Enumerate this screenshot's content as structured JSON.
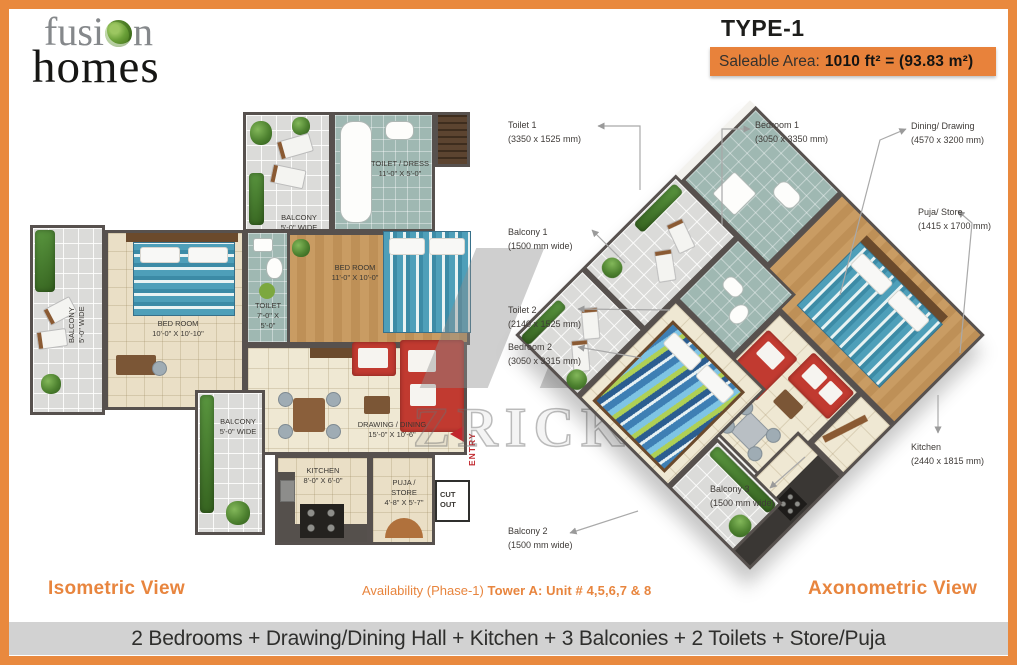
{
  "brand": {
    "line1_pre": "fusi",
    "line1_o": "o",
    "line1_post": "n",
    "line2": "homes",
    "full_name": "fusion homes"
  },
  "header": {
    "type_title": "TYPE-1",
    "saleable_label": "Saleable Area:",
    "saleable_value": "1010 ft² = (93.83 m²)"
  },
  "left_plan": {
    "rooms": {
      "toilet_dress": {
        "name": "TOILET / DRESS",
        "dims": "11'-0\" X 5'-0\""
      },
      "balcony_top": {
        "name": "BALCONY",
        "dims": "5'-0\" WIDE"
      },
      "bedroom_1": {
        "name": "BED ROOM",
        "dims": "11'-0\" X 10'-0\""
      },
      "balcony_left": {
        "name": "BALCONY",
        "dims": "5'-0\" WIDE"
      },
      "bedroom_2": {
        "name": "BED ROOM",
        "dims": "10'-0\" X 10'-10\""
      },
      "toilet": {
        "name": "TOILET",
        "dims": "7'-0\" X 5'-0\""
      },
      "drawing_dining": {
        "name": "DRAWING / DINING",
        "dims": "15'-0\" X 10'-6\""
      },
      "balcony_bottom": {
        "name": "BALCONY",
        "dims": "5'-0\" WIDE"
      },
      "kitchen": {
        "name": "KITCHEN",
        "dims": "8'-0\" X 6'-0\""
      },
      "puja_store": {
        "name": "PUJA / STORE",
        "dims": "4'-8\" X 5'-7\""
      },
      "cut_out": {
        "name": "CUT OUT"
      },
      "entry": {
        "name": "ENTRY"
      }
    }
  },
  "right_plan": {
    "callouts": [
      {
        "label": "Toilet 1",
        "dims": "(3350 x 1525 mm)"
      },
      {
        "label": "Bedroom 1",
        "dims": "(3050 x 3350 mm)"
      },
      {
        "label": "Dining/ Drawing",
        "dims": "(4570 x 3200 mm)"
      },
      {
        "label": "Balcony 1",
        "dims": "(1500 mm wide)"
      },
      {
        "label": "Puja/ Store",
        "dims": "(1415 x 1700 mm)"
      },
      {
        "label": "Toilet 2",
        "dims": "(2140 x 1525 mm)"
      },
      {
        "label": "Bedroom 2",
        "dims": "(3050 x 3315 mm)"
      },
      {
        "label": "Kitchen",
        "dims": "(2440 x 1815 mm)"
      },
      {
        "label": "Balcony 3",
        "dims": "(1500 mm wide)"
      },
      {
        "label": "Balcony 2",
        "dims": "(1500 mm wide)"
      }
    ]
  },
  "watermark": {
    "text": "ZRICKS",
    "suffix": "com"
  },
  "footer": {
    "left_view_label": "Isometric View",
    "availability_prefix": "Availability (Phase-1)",
    "availability_bold": "Tower A: Unit # 4,5,6,7 & 8",
    "right_view_label": "Axonometric View",
    "features_line": "2 Bedrooms + Drawing/Dining Hall + Kitchen + 3 Balconies + 2 Toilets + Store/Puja"
  },
  "colors": {
    "accent_orange": "#E8823B",
    "frame_orange": "#E9893E",
    "strip_gray": "#D2D2D2",
    "wall_gray": "#57514E"
  }
}
